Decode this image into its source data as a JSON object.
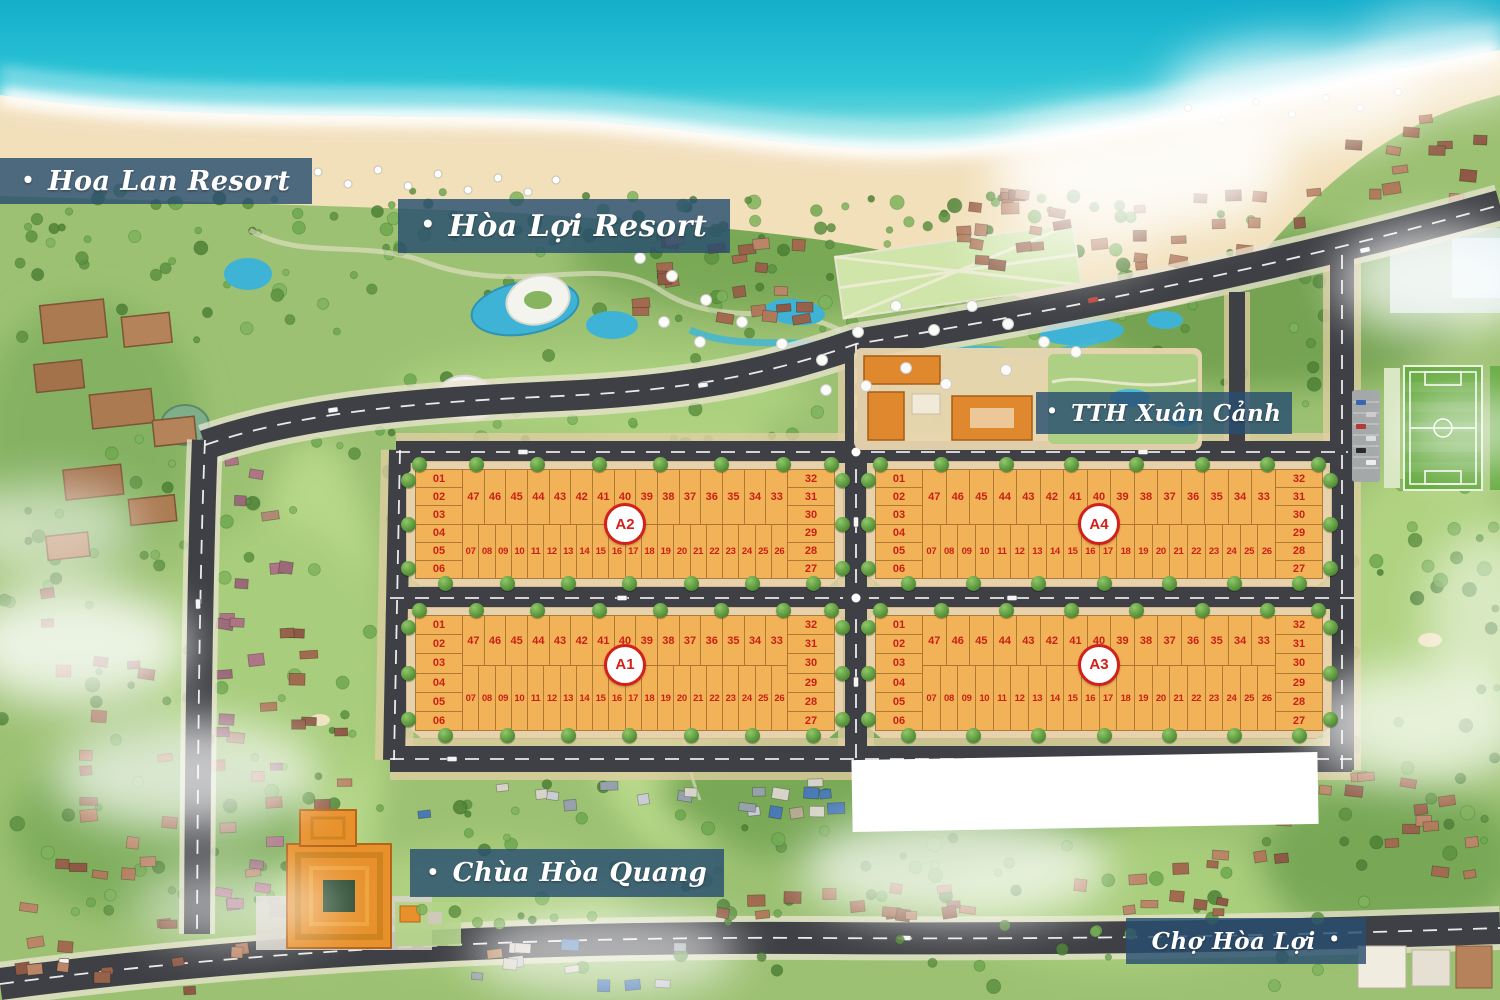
{
  "banners": {
    "bullet": "•",
    "items": [
      {
        "id": "hoa-lan-resort",
        "text": "Hoa Lan Resort",
        "bullet_position": "left"
      },
      {
        "id": "hoa-loi-resort",
        "text": "Hòa Lợi Resort",
        "bullet_position": "left"
      },
      {
        "id": "tth-xuan-canh",
        "text": "TTH Xuân Cảnh",
        "bullet_position": "left"
      },
      {
        "id": "chua-hoa-quang",
        "text": "Chùa Hòa Quang",
        "bullet_position": "left"
      },
      {
        "id": "cho-hoa-loi",
        "text": "Chợ Hòa Lợi",
        "bullet_position": "right"
      }
    ]
  },
  "blocks": [
    {
      "id": "A2",
      "position": "top-left",
      "left_column": [
        "01",
        "02",
        "03",
        "04",
        "05",
        "06"
      ],
      "top_row": [
        "47",
        "46",
        "45",
        "44",
        "43",
        "42",
        "41",
        "40",
        "39",
        "38",
        "37",
        "36",
        "35",
        "34",
        "33"
      ],
      "bottom_row": [
        "07",
        "08",
        "09",
        "10",
        "11",
        "12",
        "13",
        "14",
        "15",
        "16",
        "17",
        "18",
        "19",
        "20",
        "21",
        "22",
        "23",
        "24",
        "25",
        "26"
      ],
      "right_column": [
        "32",
        "31",
        "30",
        "29",
        "28",
        "27"
      ]
    },
    {
      "id": "A4",
      "position": "top-right",
      "left_column": [
        "01",
        "02",
        "03",
        "04",
        "05",
        "06"
      ],
      "top_row": [
        "47",
        "46",
        "45",
        "44",
        "43",
        "42",
        "41",
        "40",
        "39",
        "38",
        "37",
        "36",
        "35",
        "34",
        "33"
      ],
      "bottom_row": [
        "07",
        "08",
        "09",
        "10",
        "11",
        "12",
        "13",
        "14",
        "15",
        "16",
        "17",
        "18",
        "19",
        "20",
        "21",
        "22",
        "23",
        "24",
        "25",
        "26"
      ],
      "right_column": [
        "32",
        "31",
        "30",
        "29",
        "28",
        "27"
      ]
    },
    {
      "id": "A1",
      "position": "bottom-left",
      "left_column": [
        "01",
        "02",
        "03",
        "04",
        "05",
        "06"
      ],
      "top_row": [
        "47",
        "46",
        "45",
        "44",
        "43",
        "42",
        "41",
        "40",
        "39",
        "38",
        "37",
        "36",
        "35",
        "34",
        "33"
      ],
      "bottom_row": [
        "07",
        "08",
        "09",
        "10",
        "11",
        "12",
        "13",
        "14",
        "15",
        "16",
        "17",
        "18",
        "19",
        "20",
        "21",
        "22",
        "23",
        "24",
        "25",
        "26"
      ],
      "right_column": [
        "32",
        "31",
        "30",
        "29",
        "28",
        "27"
      ]
    },
    {
      "id": "A3",
      "position": "bottom-right",
      "left_column": [
        "01",
        "02",
        "03",
        "04",
        "05",
        "06"
      ],
      "top_row": [
        "47",
        "46",
        "45",
        "44",
        "43",
        "42",
        "41",
        "40",
        "39",
        "38",
        "37",
        "36",
        "35",
        "34",
        "33"
      ],
      "bottom_row": [
        "07",
        "08",
        "09",
        "10",
        "11",
        "12",
        "13",
        "14",
        "15",
        "16",
        "17",
        "18",
        "19",
        "20",
        "21",
        "22",
        "23",
        "24",
        "25",
        "26"
      ],
      "right_column": [
        "32",
        "31",
        "30",
        "29",
        "28",
        "27"
      ]
    }
  ],
  "colors": {
    "lot_fill": "#f2b257",
    "lot_border": "#a87c3e",
    "lot_number": "#cb1f16",
    "sidewalk": "#e7d2ac",
    "road": "#3f4045",
    "banner_bg": "#2c4e70",
    "sea": "#1ab5cc",
    "sand": "#f2e0ba",
    "land": "#9cc172"
  }
}
